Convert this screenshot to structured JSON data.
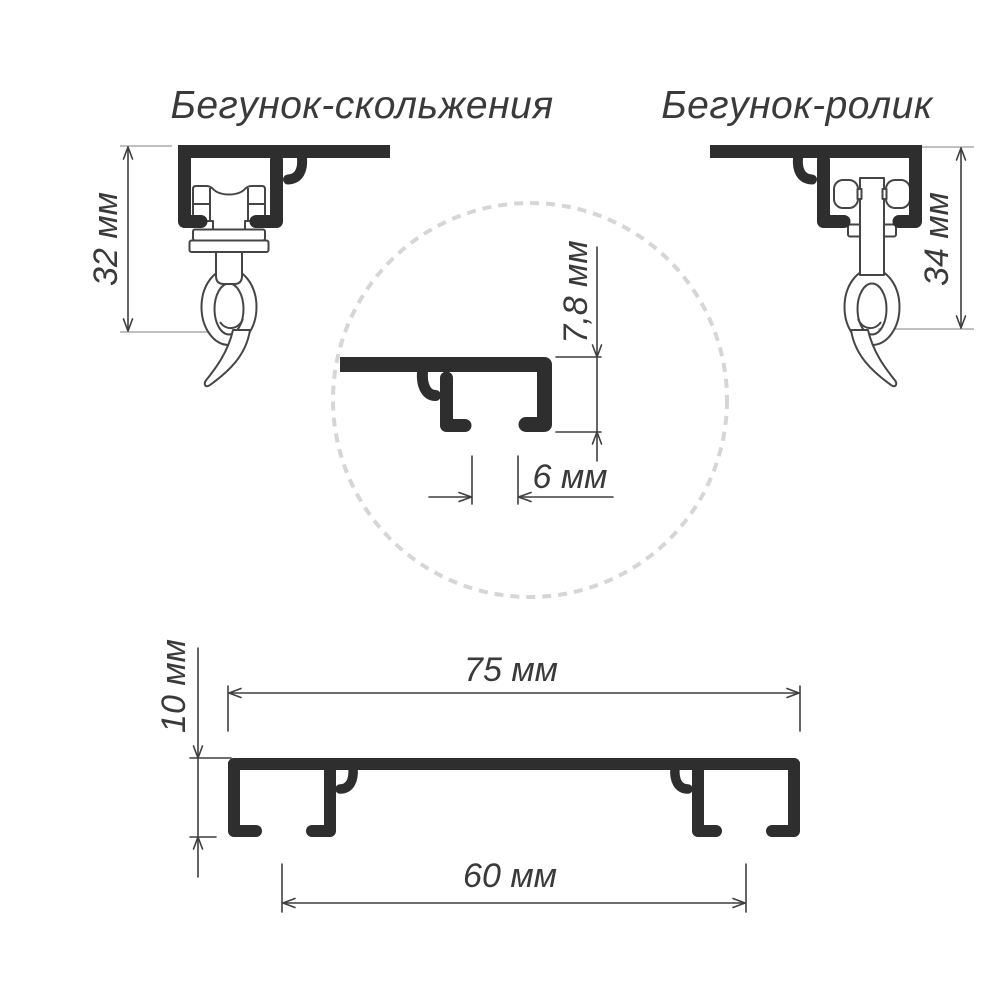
{
  "titles": {
    "left": "Бегунок-скольжения",
    "right": "Бегунок-ролик"
  },
  "dimensions": {
    "slide_runner_height": "32 мм",
    "roller_runner_height": "34 мм",
    "detail_channel_height": "7,8 мм",
    "detail_slot_width": "6 мм",
    "profile_width": "75 мм",
    "profile_height": "10 мм",
    "slot_spacing": "60 мм"
  },
  "units": "мм",
  "colors": {
    "background": "#ffffff",
    "profile_line_art": "#2e2e2e",
    "glider_outline": "#454545",
    "dimension_lines": "#3f3f3f",
    "extension_lines": "#ababab",
    "detail_circle": "#d6d6d6",
    "text": "#3a3a3a"
  }
}
